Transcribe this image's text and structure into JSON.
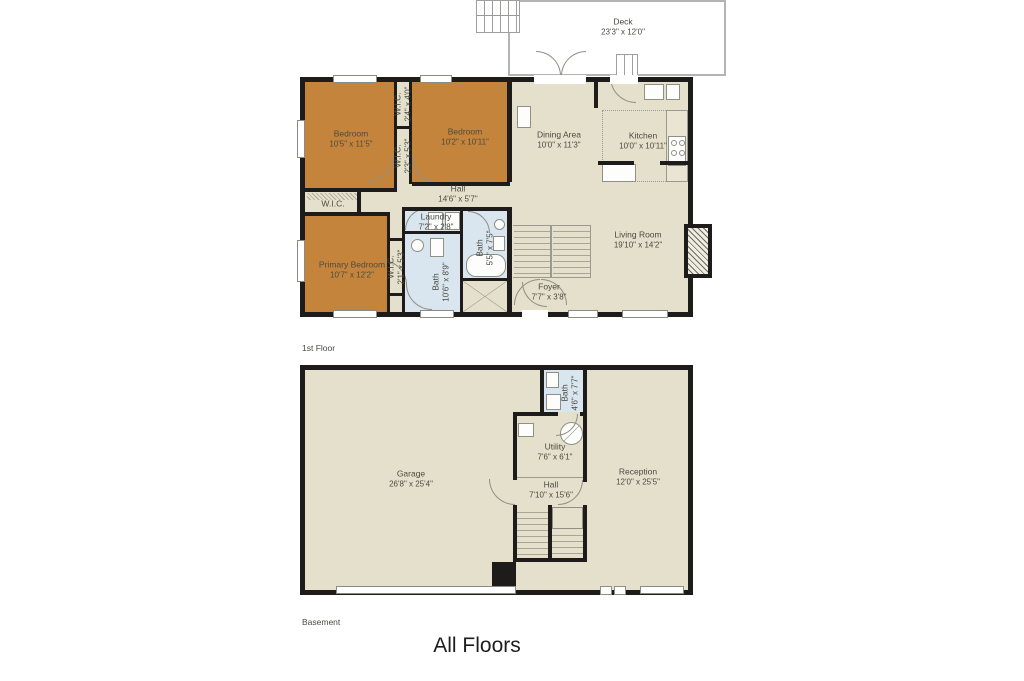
{
  "title": "All Floors",
  "colors": {
    "bedroom_fill": "#c5843c",
    "floor_fill": "#e5e0cb",
    "bath_fill": "#d9e6ef",
    "wall": "#1d1c1a",
    "deck_outline": "#b4b4b4",
    "label_text": "#4a4a40"
  },
  "first_floor": {
    "label": "1st Floor",
    "rooms": {
      "deck": {
        "name": "Deck",
        "dims": "23'3\" x 12'0\""
      },
      "bedroom1": {
        "name": "Bedroom",
        "dims": "10'5\" x 11'5\""
      },
      "bedroom2": {
        "name": "Bedroom",
        "dims": "10'2\" x 10'11\""
      },
      "wic_top": {
        "name": "W.I.C.",
        "dims": "2'4\" x 4'0\""
      },
      "wic_mid": {
        "name": "W.I.C.",
        "dims": "2'3\" x 5'3\""
      },
      "wic_left": {
        "name": "W.I.C.",
        "dims": ""
      },
      "dining": {
        "name": "Dining Area",
        "dims": "10'0\" x 11'3\""
      },
      "kitchen": {
        "name": "Kitchen",
        "dims": "10'0\" x 10'11\""
      },
      "hall": {
        "name": "Hall",
        "dims": "14'6\" x 5'7\""
      },
      "primary_bedroom": {
        "name": "Primary Bedroom",
        "dims": "10'7\" x 12'2\""
      },
      "wic_primary": {
        "name": "W.I.C.",
        "dims": "2'1\" x 5'3\""
      },
      "laundry": {
        "name": "Laundry",
        "dims": "7'2\" x 2'8\""
      },
      "bath_small": {
        "name": "Bath",
        "dims": "5'5\" x 7'5\""
      },
      "bath_large": {
        "name": "Bath",
        "dims": "10'6\" x 8'9\""
      },
      "living_room": {
        "name": "Living Room",
        "dims": "19'10\" x 14'2\""
      },
      "foyer": {
        "name": "Foyer",
        "dims": "7'7\" x 3'8\""
      }
    }
  },
  "basement": {
    "label": "Basement",
    "rooms": {
      "garage": {
        "name": "Garage",
        "dims": "26'8\" x 25'4\""
      },
      "bath": {
        "name": "Bath",
        "dims": "4'6\" x 7'7\""
      },
      "utility": {
        "name": "Utility",
        "dims": "7'6\" x 6'1\""
      },
      "hall": {
        "name": "Hall",
        "dims": "7'10\" x 15'6\""
      },
      "reception": {
        "name": "Reception",
        "dims": "12'0\" x 25'5\""
      }
    }
  }
}
